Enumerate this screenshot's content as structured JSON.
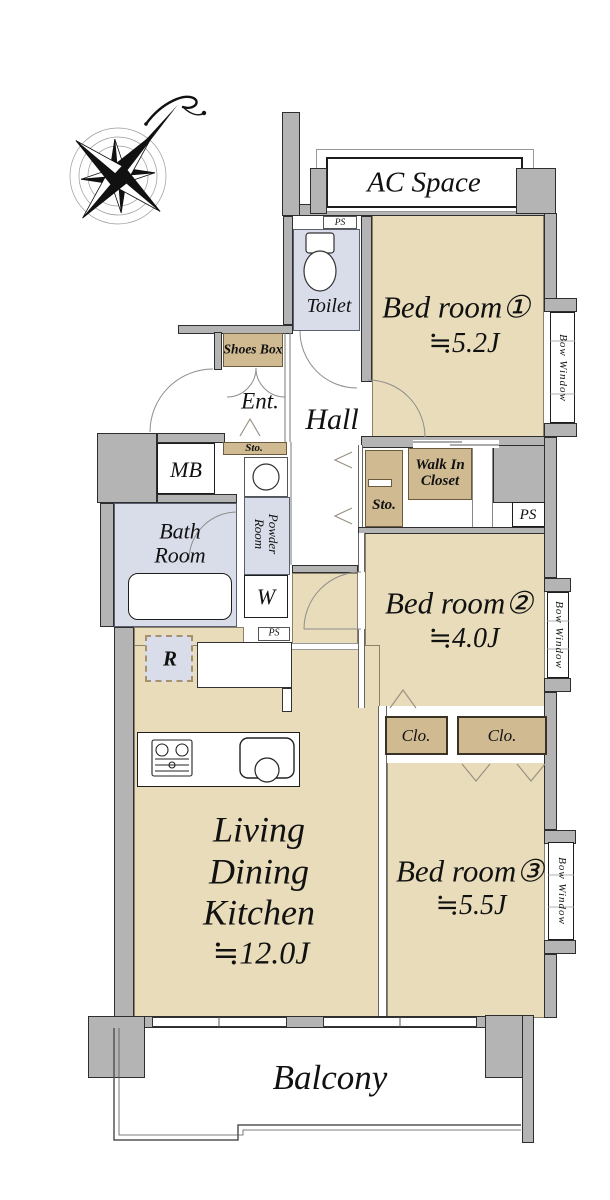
{
  "meta": {
    "type": "apartment-floor-plan",
    "colors": {
      "floor_beige": "#e8dcba",
      "storage_tan": "#cfba92",
      "wet_area_blue": "#d9dde9",
      "wall_gray": "#b4b4b4"
    },
    "icons": {
      "compass": "compass-rose-north-icon",
      "toilet": "toilet-fixture-icon",
      "bathtub": "bathtub-icon",
      "stove": "gas-stove-icon",
      "sink": "kitchen-sink-icon",
      "basin": "wash-basin-icon"
    }
  },
  "rooms": {
    "ac_space": "AC Space",
    "toilet": "Toilet",
    "hall": "Hall",
    "ent": "Ent.",
    "bath": {
      "line1": "Bath",
      "line2": "Room"
    },
    "powder": {
      "line1": "Powder",
      "line2": "Room"
    },
    "bedroom1": {
      "name": "Bed room①",
      "size": "≒5.2J"
    },
    "bedroom2": {
      "name": "Bed room②",
      "size": "≒4.0J"
    },
    "bedroom3": {
      "name": "Bed room③",
      "size": "≒5.5J"
    },
    "ldk": {
      "line1": "Living",
      "line2": "Dining",
      "line3": "Kitchen",
      "size": "≒12.0J"
    },
    "balcony": "Balcony"
  },
  "storage": {
    "shoes_box": "Shoes Box",
    "sto": "Sto.",
    "walk_in_closet": {
      "line1": "Walk In",
      "line2": "Closet"
    },
    "clo": "Clo."
  },
  "fixtures": {
    "mb": "MB",
    "w": "W",
    "r": "R",
    "ps": "PS"
  },
  "windows": {
    "bow_window": "Bow Window"
  }
}
